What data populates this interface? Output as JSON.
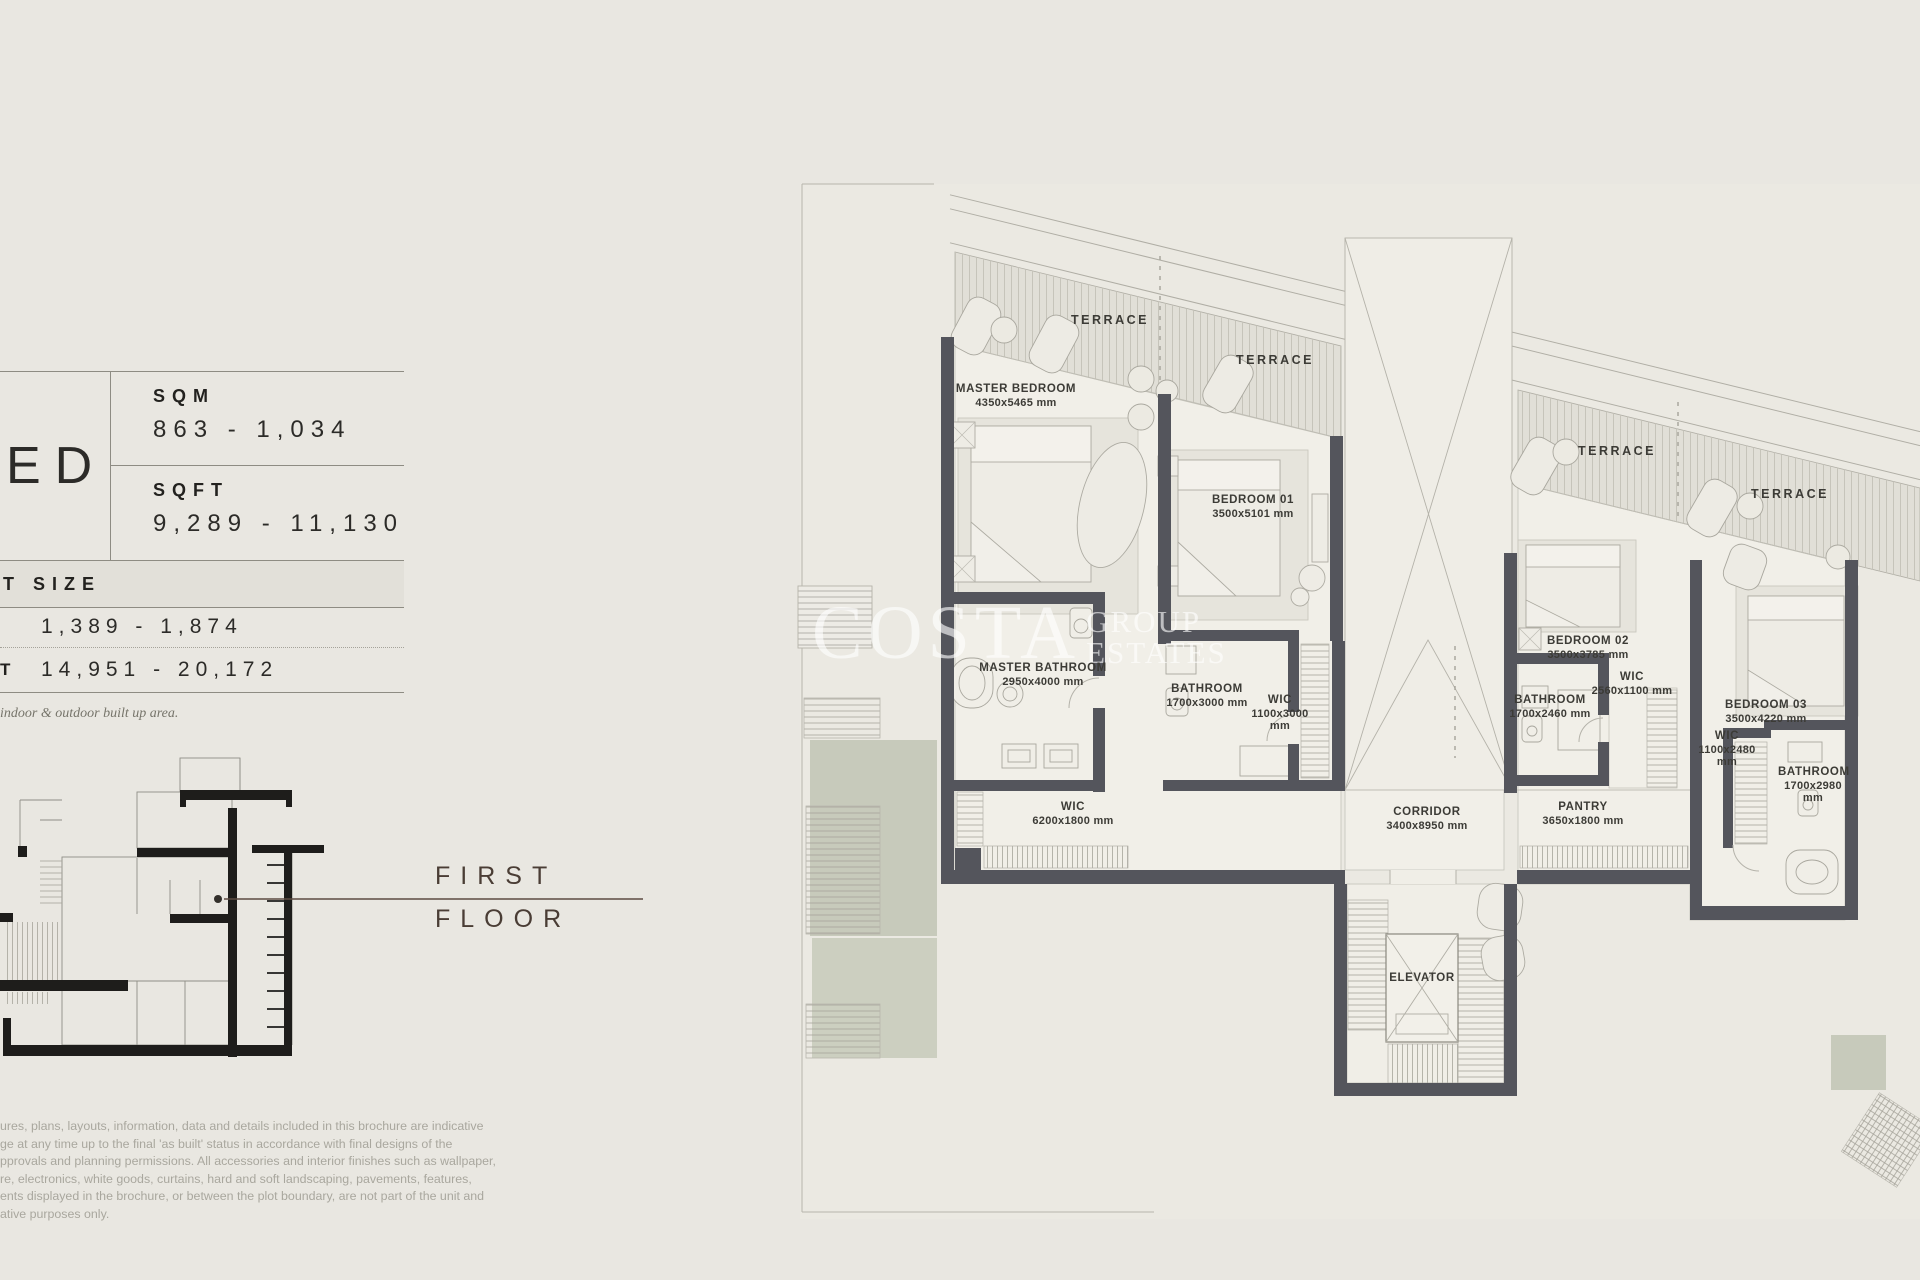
{
  "spec_panel": {
    "bed_fragment": "ED",
    "sqm_label": "SQM",
    "sqm_value": "863 - 1,034",
    "sqft_label": "SQFT",
    "sqft_value": "9,289 - 11,130",
    "plot": {
      "header_fragment": "T SIZE",
      "row1_value": "1,389 - 1,874",
      "row2_label_fragment": "T",
      "row2_value": "14,951 - 20,172",
      "note": "indoor & outdoor built up area."
    }
  },
  "floor_label": {
    "line1": "FIRST",
    "line2": "FLOOR"
  },
  "watermark": {
    "word1": "COSTA",
    "word2": "GROUP",
    "word3": "ESTATES"
  },
  "disclaimer": {
    "lines": [
      "ures, plans, layouts, information, data and details included in this brochure are indicative",
      "ge at any time up to the final 'as built' status in accordance with final designs of the",
      "pprovals and planning permissions. All accessories and interior finishes such as wallpaper,",
      "re, electronics, white goods, curtains, hard and soft landscaping, pavements, features,",
      "ents displayed in the brochure, or between the plot boundary, are not part of the unit and",
      "ative purposes only."
    ]
  },
  "floor_plan": {
    "rooms": [
      {
        "id": "terrace-1",
        "name": "TERRACE",
        "dims": null,
        "x": 1110,
        "y": 320,
        "cls": "terrace"
      },
      {
        "id": "terrace-2",
        "name": "TERRACE",
        "dims": null,
        "x": 1275,
        "y": 360,
        "cls": "terrace"
      },
      {
        "id": "terrace-3",
        "name": "TERRACE",
        "dims": null,
        "x": 1617,
        "y": 451,
        "cls": "terrace"
      },
      {
        "id": "terrace-4",
        "name": "TERRACE",
        "dims": null,
        "x": 1790,
        "y": 494,
        "cls": "terrace"
      },
      {
        "id": "master-bedroom",
        "name": "MASTER BEDROOM",
        "dims": "4350x5465 mm",
        "x": 1016,
        "y": 396
      },
      {
        "id": "bedroom-01",
        "name": "BEDROOM 01",
        "dims": "3500x5101 mm",
        "x": 1253,
        "y": 507
      },
      {
        "id": "master-bathroom",
        "name": "MASTER BATHROOM",
        "dims": "2950x4000 mm",
        "x": 1043,
        "y": 675
      },
      {
        "id": "bathroom-01",
        "name": "BATHROOM",
        "dims": "1700x3000 mm",
        "x": 1207,
        "y": 696
      },
      {
        "id": "wic-bedroom-01",
        "name": "WIC",
        "dims": "1100x3000 mm",
        "x": 1280,
        "y": 713,
        "cls": "narrow"
      },
      {
        "id": "wic-master",
        "name": "WIC",
        "dims": "6200x1800 mm",
        "x": 1073,
        "y": 814
      },
      {
        "id": "corridor",
        "name": "CORRIDOR",
        "dims": "3400x8950 mm",
        "x": 1427,
        "y": 819
      },
      {
        "id": "bedroom-02",
        "name": "BEDROOM 02",
        "dims": "3500x3785 mm",
        "x": 1588,
        "y": 648
      },
      {
        "id": "bathroom-02",
        "name": "BATHROOM",
        "dims": "1700x2460 mm",
        "x": 1550,
        "y": 707
      },
      {
        "id": "wic-bedroom-02",
        "name": "WIC",
        "dims": "2560x1100 mm",
        "x": 1632,
        "y": 684
      },
      {
        "id": "bedroom-03",
        "name": "BEDROOM 03",
        "dims": "3500x4220 mm",
        "x": 1766,
        "y": 712
      },
      {
        "id": "wic-bedroom-03",
        "name": "WIC",
        "dims": "1100x2480 mm",
        "x": 1727,
        "y": 749,
        "cls": "narrow"
      },
      {
        "id": "bathroom-03",
        "name": "BATHROOM",
        "dims": "1700x2980 mm",
        "x": 1813,
        "y": 785,
        "cls": "narrow"
      },
      {
        "id": "pantry",
        "name": "PANTRY",
        "dims": "3650x1800 mm",
        "x": 1583,
        "y": 814
      },
      {
        "id": "elevator",
        "name": "ELEVATOR",
        "dims": null,
        "x": 1422,
        "y": 978
      }
    ]
  },
  "colors": {
    "page_bg": "#e9e7e1",
    "wall": "#54555c",
    "landscape_green": "#c7cabb",
    "accent_brown": "#5d4c42",
    "label_ink": "#3c3b36"
  }
}
